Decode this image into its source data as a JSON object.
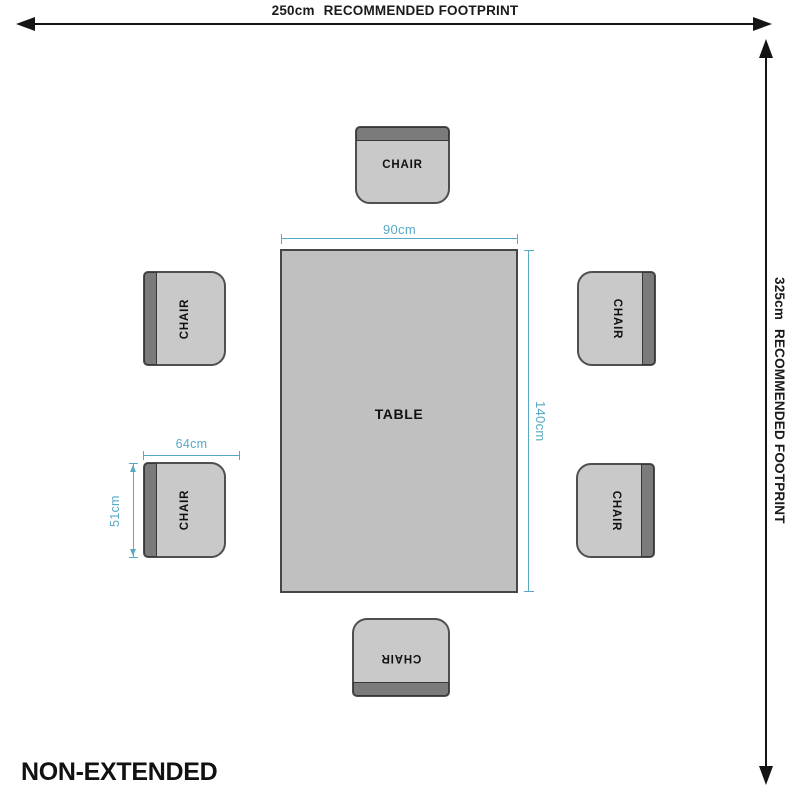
{
  "diagram": {
    "variant_label": "NON-EXTENDED",
    "footprint": {
      "width": {
        "value": "250cm",
        "label": "RECOMMENDED FOOTPRINT"
      },
      "height": {
        "value": "325cm",
        "label": "RECOMMENDED FOOTPRINT"
      }
    },
    "table": {
      "label": "TABLE",
      "width": "90cm",
      "length": "140cm"
    },
    "chair": {
      "label": "CHAIR",
      "width": "64cm",
      "depth": "51cm"
    },
    "colors": {
      "dimension_accent": "#57a9c5",
      "arrow": "#141414",
      "table_fill": "#c0c0c0",
      "chair_fill": "#c9c9c9",
      "chair_backrest": "#7b7b7b",
      "outline": "#4f4f4f",
      "background": "#ffffff"
    }
  }
}
